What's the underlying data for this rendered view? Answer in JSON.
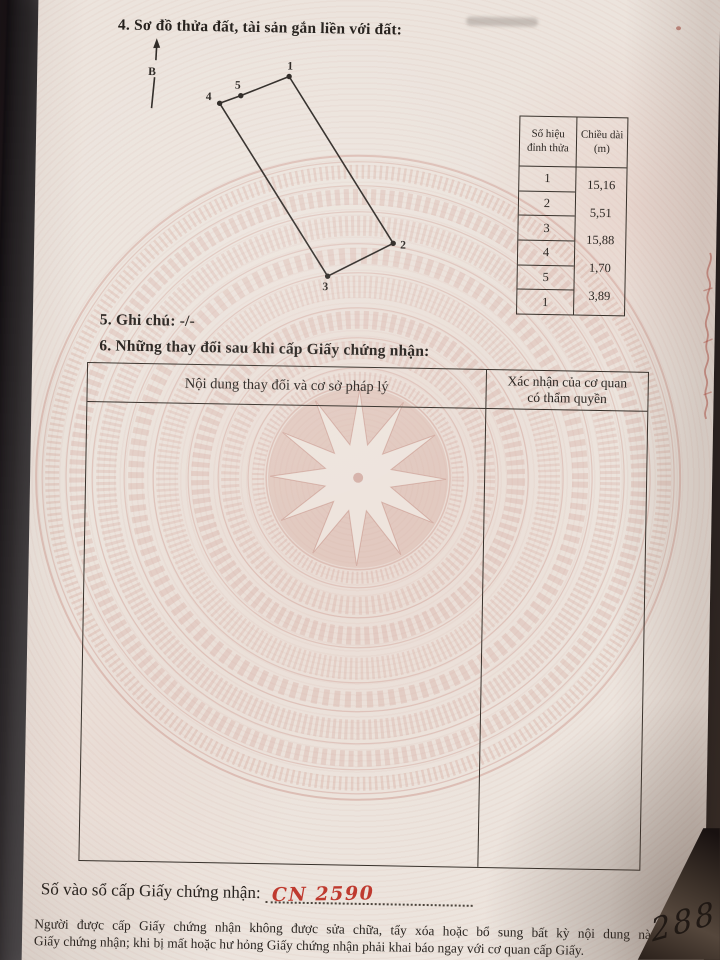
{
  "document": {
    "section4_heading": "4. Sơ đồ thửa đất, tài sản gắn liền với đất:",
    "north_label": "B",
    "plot_diagram": {
      "vertex_labels": [
        "1",
        "2",
        "3",
        "4",
        "5"
      ]
    },
    "vertex_table": {
      "header_col1_line1": "Số hiệu",
      "header_col1_line2": "đỉnh thửa",
      "header_col2_line1": "Chiều dài",
      "header_col2_line2": "(m)",
      "vertex_numbers": [
        "1",
        "2",
        "3",
        "4",
        "5",
        "1"
      ],
      "lengths_m": [
        "15,16",
        "5,51",
        "15,88",
        "1,70",
        "3,89"
      ]
    },
    "section5_heading": "5. Ghi chú: -/-",
    "section6_heading": "6. Những thay đổi sau khi cấp Giấy chứng nhận:",
    "changes_table": {
      "col1_header": "Nội dung thay đổi và cơ sở pháp lý",
      "col2_header_line1": "Xác nhận của cơ quan",
      "col2_header_line2": "có thẩm quyền"
    },
    "registry_label": "Số vào sổ cấp Giấy chứng nhận:",
    "registry_number_handwritten": "CN 2590",
    "footer_note_line1": "Người được cấp Giấy chứng nhận không được sửa chữa, tẩy xóa hoặc bổ sung bất kỳ nội dung nào trong",
    "footer_note_line2": "Giấy chứng nhận; khi bị mất hoặc hư hỏng Giấy chứng nhận phải khai báo ngay với cơ quan cấp Giấy.",
    "corner_handwriting": "288"
  },
  "colors": {
    "paper": "#ece4dd",
    "ink": "#28231f",
    "table_line": "#37312b",
    "handwriting_red": "#bf3a2f",
    "watermark_pink": "#cf9e93",
    "photo_background": "#241c1e"
  }
}
